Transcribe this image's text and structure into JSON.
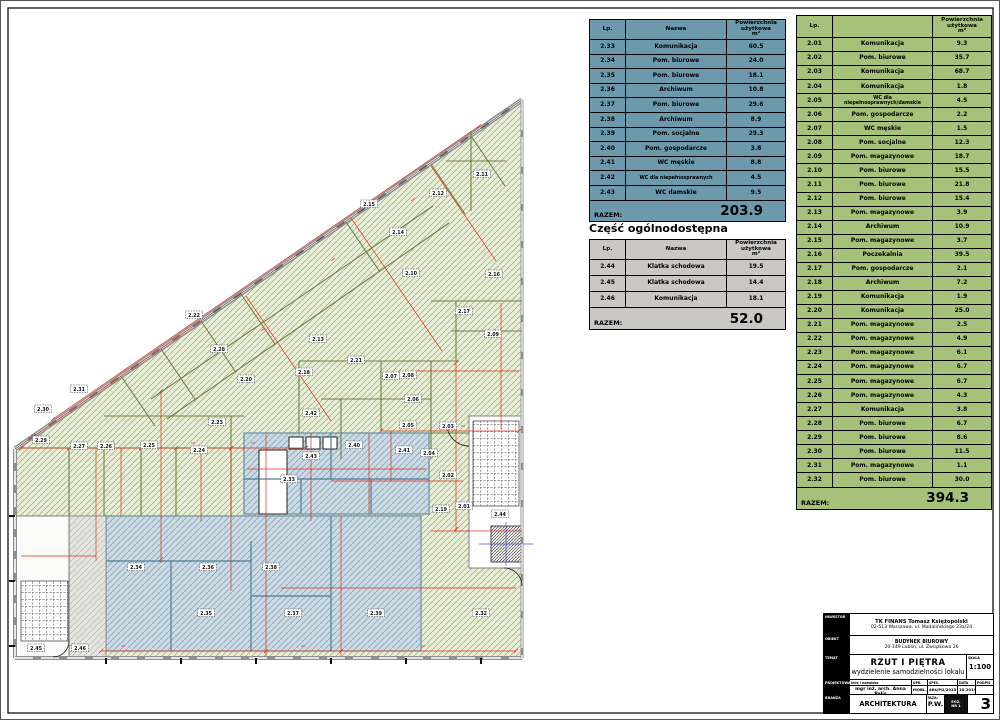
{
  "heading_common": "Część ogólnodostępna",
  "colors": {
    "table_blue": "#6d99ad",
    "table_green": "#a6c179",
    "table_gray": "#c9c8c2",
    "plan_green_fill": "#e9eed8",
    "plan_blue_fill": "#ccdbe6",
    "annotation_red": "#e0301e"
  },
  "tables": {
    "lokal_biurowy_1": {
      "headers": {
        "lp": "Lp.",
        "nazwa": "Nazwa",
        "area_line1": "Powierzchnia użytkowa",
        "area_line2": "m²"
      },
      "rows": [
        {
          "lp": "2.33",
          "nazwa": "Komunikacja",
          "area": "60.5"
        },
        {
          "lp": "2.34",
          "nazwa": "Pom. biurowe",
          "area": "24.0"
        },
        {
          "lp": "2.35",
          "nazwa": "Pom. biurowe",
          "area": "18.1"
        },
        {
          "lp": "2.36",
          "nazwa": "Archiwum",
          "area": "10.8"
        },
        {
          "lp": "2.37",
          "nazwa": "Pom. biurowe",
          "area": "29.6"
        },
        {
          "lp": "2.38",
          "nazwa": "Archiwum",
          "area": "8.9"
        },
        {
          "lp": "2.39",
          "nazwa": "Pom. socjalne",
          "area": "29.3"
        },
        {
          "lp": "2.40",
          "nazwa": "Pom. gospodarcze",
          "area": "3.8"
        },
        {
          "lp": "2.41",
          "nazwa": "WC męskie",
          "area": "8.8"
        },
        {
          "lp": "2.42",
          "nazwa": "WC dla niepełnosprawnych",
          "area": "4.5"
        },
        {
          "lp": "2.43",
          "nazwa": "WC damskie",
          "area": "9.5"
        }
      ],
      "total_label": "RAZEM:",
      "total_value": "203.9"
    },
    "ogolnodostepna": {
      "headers": {
        "lp": "Lp.",
        "nazwa": "Nazwa",
        "area_line1": "Powierzchnia użytkowa",
        "area_line2": "m²"
      },
      "rows": [
        {
          "lp": "2.44",
          "nazwa": "Klatka schodowa",
          "area": "19.5"
        },
        {
          "lp": "2.45",
          "nazwa": "Klatka schodowa",
          "area": "14.4"
        },
        {
          "lp": "2.46",
          "nazwa": "Komunikacja",
          "area": "18.1"
        }
      ],
      "total_label": "RAZEM:",
      "total_value": "52.0"
    },
    "lokal_biurowy_2": {
      "headers": {
        "lp": "Lp.",
        "nazwa": "",
        "area_line1": "Powierzchnia użytkowa",
        "area_line2": "m²"
      },
      "rows": [
        {
          "lp": "2.01",
          "nazwa": "Komunikacja",
          "area": "9.3"
        },
        {
          "lp": "2.02",
          "nazwa": "Pom. biurowe",
          "area": "35.7"
        },
        {
          "lp": "2.03",
          "nazwa": "Komunikacja",
          "area": "68.7"
        },
        {
          "lp": "2.04",
          "nazwa": "Komunikacja",
          "area": "1.8"
        },
        {
          "lp": "2.05",
          "nazwa": "WC dla niepełnosprawnych/damskie",
          "area": "4.5"
        },
        {
          "lp": "2.06",
          "nazwa": "Pom. gospodarcze",
          "area": "2.2"
        },
        {
          "lp": "2.07",
          "nazwa": "WC męskie",
          "area": "1.5"
        },
        {
          "lp": "2.08",
          "nazwa": "Pom. socjalne",
          "area": "12.3"
        },
        {
          "lp": "2.09",
          "nazwa": "Pom. magazynowe",
          "area": "18.7"
        },
        {
          "lp": "2.10",
          "nazwa": "Pom. biurowe",
          "area": "15.5"
        },
        {
          "lp": "2.11",
          "nazwa": "Pom. biurowe",
          "area": "21.8"
        },
        {
          "lp": "2.12",
          "nazwa": "Pom. biurowe",
          "area": "15.4"
        },
        {
          "lp": "2.13",
          "nazwa": "Pom. magazynowe",
          "area": "3.9"
        },
        {
          "lp": "2.14",
          "nazwa": "Archiwum",
          "area": "10.9"
        },
        {
          "lp": "2.15",
          "nazwa": "Pom. magazynowe",
          "area": "3.7"
        },
        {
          "lp": "2.16",
          "nazwa": "Poczekalnia",
          "area": "39.5"
        },
        {
          "lp": "2.17",
          "nazwa": "Pom. gospodarcze",
          "area": "2.1"
        },
        {
          "lp": "2.18",
          "nazwa": "Archiwum",
          "area": "7.2"
        },
        {
          "lp": "2.19",
          "nazwa": "Komunikacja",
          "area": "1.9"
        },
        {
          "lp": "2.20",
          "nazwa": "Komunikacja",
          "area": "25.0"
        },
        {
          "lp": "2.21",
          "nazwa": "Pom. magazynowe",
          "area": "2.5"
        },
        {
          "lp": "2.22",
          "nazwa": "Pom. magazynowe",
          "area": "4.9"
        },
        {
          "lp": "2.23",
          "nazwa": "Pom. magazynowe",
          "area": "6.1"
        },
        {
          "lp": "2.24",
          "nazwa": "Pom. magazynowe",
          "area": "6.7"
        },
        {
          "lp": "2.25",
          "nazwa": "Pom. magazynowe",
          "area": "6.7"
        },
        {
          "lp": "2.26",
          "nazwa": "Pom. magazynowe",
          "area": "4.3"
        },
        {
          "lp": "2.27",
          "nazwa": "Komunikacja",
          "area": "3.8"
        },
        {
          "lp": "2.28",
          "nazwa": "Pom. biurowe",
          "area": "6.7"
        },
        {
          "lp": "2.29",
          "nazwa": "Pom. biurowe",
          "area": "8.6"
        },
        {
          "lp": "2.30",
          "nazwa": "Pom. biurowe",
          "area": "11.5"
        },
        {
          "lp": "2.31",
          "nazwa": "Pom. magazynowe",
          "area": "1.1"
        },
        {
          "lp": "2.32",
          "nazwa": "Pom. biurowe",
          "area": "30.0"
        }
      ],
      "total_label": "RAZEM:",
      "total_value": "394.3"
    }
  },
  "plan": {
    "room_labels": [
      {
        "n": "2.01",
        "x": 463,
        "y": 505
      },
      {
        "n": "2.02",
        "x": 447,
        "y": 474
      },
      {
        "n": "2.03",
        "x": 447,
        "y": 425
      },
      {
        "n": "2.04",
        "x": 428,
        "y": 452
      },
      {
        "n": "2.05",
        "x": 407,
        "y": 424
      },
      {
        "n": "2.06",
        "x": 412,
        "y": 398
      },
      {
        "n": "2.07",
        "x": 390,
        "y": 375
      },
      {
        "n": "2.08",
        "x": 407,
        "y": 374
      },
      {
        "n": "2.09",
        "x": 492,
        "y": 333
      },
      {
        "n": "2.10",
        "x": 410,
        "y": 272
      },
      {
        "n": "2.11",
        "x": 481,
        "y": 173
      },
      {
        "n": "2.12",
        "x": 437,
        "y": 192
      },
      {
        "n": "2.13",
        "x": 317,
        "y": 338
      },
      {
        "n": "2.14",
        "x": 397,
        "y": 231
      },
      {
        "n": "2.15",
        "x": 368,
        "y": 203
      },
      {
        "n": "2.16",
        "x": 493,
        "y": 273
      },
      {
        "n": "2.17",
        "x": 463,
        "y": 310
      },
      {
        "n": "2.18",
        "x": 303,
        "y": 371
      },
      {
        "n": "2.19",
        "x": 440,
        "y": 508
      },
      {
        "n": "2.20",
        "x": 245,
        "y": 378
      },
      {
        "n": "2.21",
        "x": 355,
        "y": 359
      },
      {
        "n": "2.22",
        "x": 193,
        "y": 314
      },
      {
        "n": "2.23",
        "x": 216,
        "y": 421
      },
      {
        "n": "2.24",
        "x": 198,
        "y": 449
      },
      {
        "n": "2.25",
        "x": 148,
        "y": 444
      },
      {
        "n": "2.26",
        "x": 105,
        "y": 445
      },
      {
        "n": "2.27",
        "x": 78,
        "y": 445
      },
      {
        "n": "2.28",
        "x": 218,
        "y": 348
      },
      {
        "n": "2.29",
        "x": 40,
        "y": 439
      },
      {
        "n": "2.30",
        "x": 42,
        "y": 408
      },
      {
        "n": "2.31",
        "x": 78,
        "y": 388
      },
      {
        "n": "2.32",
        "x": 480,
        "y": 612
      },
      {
        "n": "2.33",
        "x": 288,
        "y": 478
      },
      {
        "n": "2.34",
        "x": 135,
        "y": 566
      },
      {
        "n": "2.35",
        "x": 205,
        "y": 612
      },
      {
        "n": "2.36",
        "x": 207,
        "y": 566
      },
      {
        "n": "2.37",
        "x": 292,
        "y": 612
      },
      {
        "n": "2.38",
        "x": 270,
        "y": 566
      },
      {
        "n": "2.39",
        "x": 375,
        "y": 612
      },
      {
        "n": "2.40",
        "x": 353,
        "y": 444
      },
      {
        "n": "2.41",
        "x": 403,
        "y": 449
      },
      {
        "n": "2.42",
        "x": 310,
        "y": 412
      },
      {
        "n": "2.43",
        "x": 310,
        "y": 455
      },
      {
        "n": "2.44",
        "x": 499,
        "y": 513
      },
      {
        "n": "2.45",
        "x": 35,
        "y": 647
      },
      {
        "n": "2.46",
        "x": 79,
        "y": 647
      }
    ]
  },
  "title_block": {
    "investor_label": "INWESTOR",
    "investor_name": "TK FINANS Tomasz Księżopolski",
    "investor_addr": "02-513 Warszawa, ul. Madalińskiego 23a/24",
    "object_label": "OBIEKT",
    "object_name": "BUDYNEK BIUROWY",
    "object_addr": "20-149 Lublin, ul. Związkowa 26",
    "subject_label": "TEMAT",
    "drawing_title": "RZUT I PIĘTRA",
    "drawing_subtitle": "wydzielenie samodzielności lokalu",
    "scale_label": "SKALA",
    "scale_value": "1:100",
    "designer_label": "PROJEKTOWAŁ",
    "designer_col_label": "imię i nazwisko",
    "designer_name": "mgr inż. arch. Anna Palis",
    "upr_label": "UPR.",
    "upr_value": "MOBL.",
    "spec_label": "SPEC.",
    "spec_value": "464/PO/2015",
    "date_label": "DATA",
    "date_value": "10.2019",
    "sign_label": "PODPIS",
    "sign_value": "",
    "branch_label": "BRANŻA",
    "branch_value": "ARCHITEKTURA",
    "phase_label": "FAZA:",
    "phase_value": "P.W.",
    "stamp_line1": "EGZ.",
    "stamp_line2": "NR 1",
    "sheet_number": "3"
  }
}
